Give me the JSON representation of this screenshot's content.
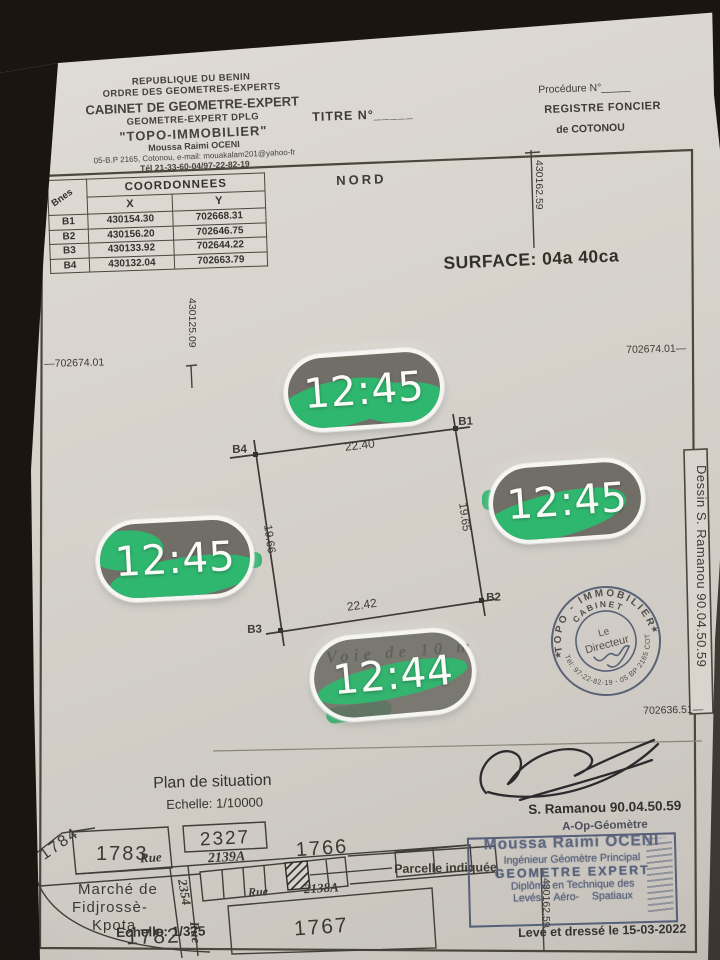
{
  "letterhead": {
    "line1": "REPUBLIQUE DU BENIN",
    "line2": "ORDRE DES GEOMETRES-EXPERTS",
    "line3": "CABINET DE GEOMETRE-EXPERT",
    "line4": "GEOMETRE-EXPERT  DPLG",
    "line5": "\"TOPO-IMMOBILIER\"",
    "line6": "Moussa Raimi OCENI",
    "line7": "05-B.P 2165, Cotonou, e-mail: mouakalam201@yahoo-fr",
    "line8": "Tél 21-33-60-04/97-22-82-19"
  },
  "titre": "TITRE N°_____",
  "registre": {
    "procedure": "Procédure N°_____",
    "line1": "REGISTRE FONCIER",
    "line2": "de COTONOU"
  },
  "nord": "NORD",
  "surface": "SURFACE: 04a 40ca",
  "coord_table": {
    "title": "COORDONNEES",
    "col_bornes": "Bnes",
    "col_x": "X",
    "col_y": "Y",
    "rows": [
      {
        "b": "B1",
        "x": "430154.30",
        "y": "702668.31"
      },
      {
        "b": "B2",
        "x": "430156.20",
        "y": "702646.75"
      },
      {
        "b": "B3",
        "x": "430133.92",
        "y": "702644.22"
      },
      {
        "b": "B4",
        "x": "430132.04",
        "y": "702663.79"
      }
    ]
  },
  "edge_labels": {
    "top_right_vertical": "430162.59",
    "mid_left_vertical": "430125.09",
    "left": "—702674.01",
    "right": "702674.01—",
    "bottom_right": "702636.51—",
    "bottom_vertical": "430162.59"
  },
  "parcel": {
    "b1": "B1",
    "b2": "B2",
    "b3": "B3",
    "b4": "B4",
    "dim_top": "22.40",
    "dim_right": "19.65",
    "dim_bottom": "22.42",
    "dim_left": "19.66",
    "road": "Voie de 10 m"
  },
  "timestamps": {
    "t1": "12:45",
    "t2": "12:45",
    "t3": "12:45",
    "t4": "12:44"
  },
  "round_stamp": {
    "arc_top": "TOPO - IMMOBILIER",
    "arc_cabinet": "CABINET",
    "arc_bottom": "Tél: 97-22-82-19 - 05 BP 2165 COT",
    "star_left": "★",
    "star_right": "★",
    "center1": "Le",
    "center2": "Directeur"
  },
  "dessin_box": "Dessin S. Ramanou 90.04.50.59",
  "signature": {
    "name": "S. Ramanou 90.04.50.59",
    "role": "A-Op-Géomètre"
  },
  "plan_situation": {
    "title": "Plan de situation",
    "scale": "Echelle: 1/10000"
  },
  "map": {
    "p1784": "1784",
    "p1783": "1783",
    "p2327": "2327",
    "p2139a": "2139A",
    "rue1": "Rue",
    "p2354": "2354",
    "p1766": "1766",
    "rue2": "Rue",
    "p2138a": "2138A",
    "marche1": "Marché de",
    "marche2": "Fidjrossè-",
    "marche3": "Kpota",
    "p1782": "1782",
    "p1767": "1767",
    "rue3": "Rue",
    "parcelle_indiquee": "Parcelle indiquée"
  },
  "expert_stamp": {
    "l1": "Moussa Raimi OCENI",
    "l2": "Ingénieur  Géomètre Principal",
    "l3": "GEOMETRE  EXPERT",
    "l4": "Diplômé en Technique des",
    "l5": "Levés Aéro- Spatiaux"
  },
  "footer": {
    "scale": "Echelle: 1/375",
    "date": "Levé et dressé le 15-03-2022"
  },
  "colors": {
    "paper": "#d7d3cc",
    "ink": "#3c3a36",
    "stamp_ink": "#57617c",
    "pill_green": "#2fb76f",
    "pill_gray": "#706e67",
    "photo_edge": "#1b1512"
  }
}
